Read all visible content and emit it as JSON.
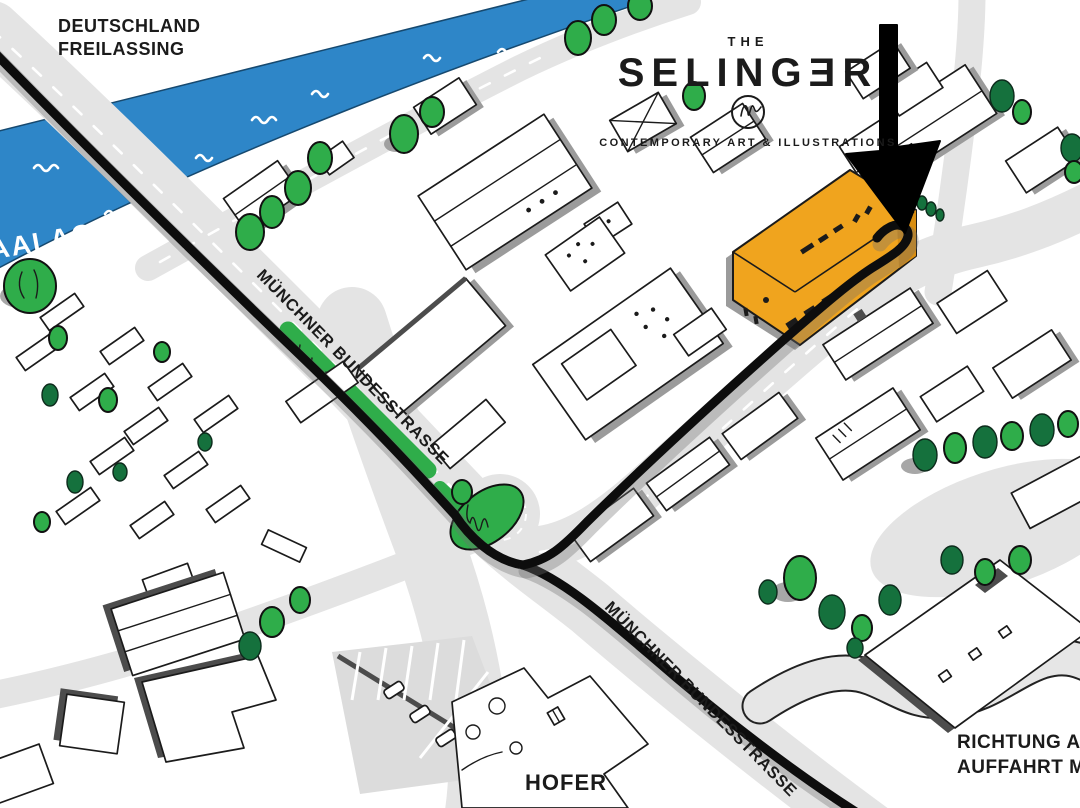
{
  "logo": {
    "the": "THE",
    "name": "SELINGƎR",
    "tagline": "CONTEMPORARY ART & ILLUSTRATIONS"
  },
  "labels": {
    "region_line1": "DEUTSCHLAND",
    "region_line2": "FREILASSING",
    "river": "SAALACH",
    "road_upper": "MÜNCHNER BUNDESSTRASSE",
    "road_lower": "MÜNCHNER BUNDESSTRASSE",
    "store": "HOFER",
    "direction_line1": "RICHTUNG A1",
    "direction_line2": "AUFFAHRT MITT"
  },
  "colors": {
    "river": "#2E86C8",
    "road": "#E4E4E4",
    "treeBright": "#2FAD4A",
    "treeDark": "#15713D",
    "gallery": "#F0A41E",
    "galleryDark": "#D98E12",
    "route": "#0d0d0d",
    "ink": "#1b1b1b"
  }
}
